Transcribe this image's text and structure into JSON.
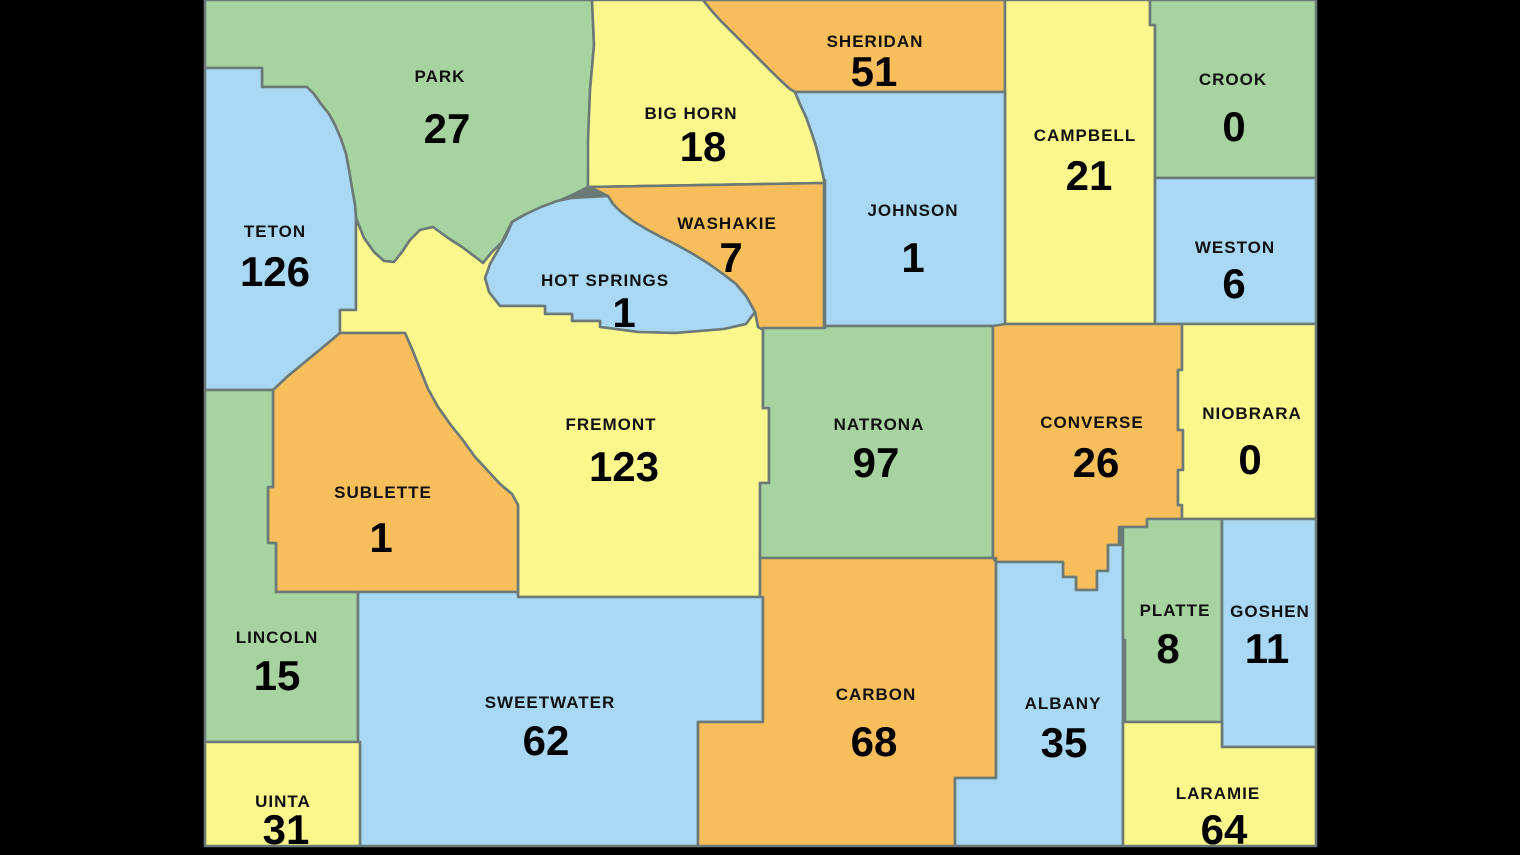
{
  "map": {
    "title": "Wyoming counties map with counts",
    "background_color": "#000000",
    "border_color": "#6b7977",
    "text_color": "#000000",
    "palette": {
      "green": "#a7d3a0",
      "yellow": "#fbf78d",
      "orange": "#f8be5b",
      "blue": "#a8d8f4"
    },
    "counties": [
      {
        "id": "park",
        "name": "PARK",
        "value": "27",
        "color": "green"
      },
      {
        "id": "big-horn",
        "name": "BIG HORN",
        "value": "18",
        "color": "yellow"
      },
      {
        "id": "sheridan",
        "name": "SHERIDAN",
        "value": "51",
        "color": "orange"
      },
      {
        "id": "campbell",
        "name": "CAMPBELL",
        "value": "21",
        "color": "yellow"
      },
      {
        "id": "crook",
        "name": "CROOK",
        "value": "0",
        "color": "green"
      },
      {
        "id": "weston",
        "name": "WESTON",
        "value": "6",
        "color": "blue"
      },
      {
        "id": "johnson",
        "name": "JOHNSON",
        "value": "1",
        "color": "blue"
      },
      {
        "id": "washakie",
        "name": "WASHAKIE",
        "value": "7",
        "color": "orange"
      },
      {
        "id": "hot-springs",
        "name": "HOT SPRINGS",
        "value": "1",
        "color": "blue"
      },
      {
        "id": "teton",
        "name": "TETON",
        "value": "126",
        "color": "blue"
      },
      {
        "id": "fremont",
        "name": "FREMONT",
        "value": "123",
        "color": "yellow"
      },
      {
        "id": "natrona",
        "name": "NATRONA",
        "value": "97",
        "color": "green"
      },
      {
        "id": "converse",
        "name": "CONVERSE",
        "value": "26",
        "color": "orange"
      },
      {
        "id": "niobrara",
        "name": "NIOBRARA",
        "value": "0",
        "color": "yellow"
      },
      {
        "id": "sublette",
        "name": "SUBLETTE",
        "value": "1",
        "color": "orange"
      },
      {
        "id": "lincoln",
        "name": "LINCOLN",
        "value": "15",
        "color": "green"
      },
      {
        "id": "sweetwater",
        "name": "SWEETWATER",
        "value": "62",
        "color": "blue"
      },
      {
        "id": "carbon",
        "name": "CARBON",
        "value": "68",
        "color": "orange"
      },
      {
        "id": "albany",
        "name": "ALBANY",
        "value": "35",
        "color": "blue"
      },
      {
        "id": "platte",
        "name": "PLATTE",
        "value": "8",
        "color": "green"
      },
      {
        "id": "goshen",
        "name": "GOSHEN",
        "value": "11",
        "color": "blue"
      },
      {
        "id": "uinta",
        "name": "UINTA",
        "value": "31",
        "color": "yellow"
      },
      {
        "id": "laramie",
        "name": "LARAMIE",
        "value": "64",
        "color": "yellow"
      }
    ]
  }
}
